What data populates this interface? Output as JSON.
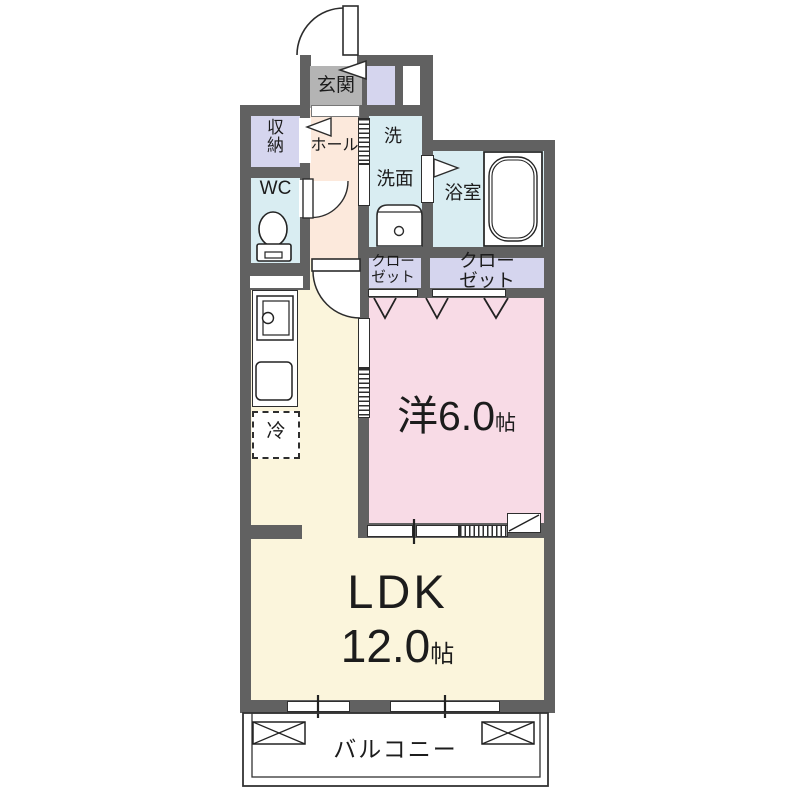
{
  "rooms": {
    "genkan": {
      "label": "玄関"
    },
    "storage": {
      "label": "収\n納"
    },
    "wc": {
      "label": "WC"
    },
    "hall": {
      "label": "ホール"
    },
    "laundry": {
      "label": "洗"
    },
    "washroom": {
      "label": "洗面"
    },
    "bathroom": {
      "label": "浴室"
    },
    "closet_left": {
      "label": "クロー\nゼット"
    },
    "closet_right": {
      "label": "クロー\nゼット"
    },
    "western_room": {
      "label": "洋6.0",
      "unit": "帖"
    },
    "refrigerator": {
      "label": "冷"
    },
    "ldk": {
      "label": "LDK",
      "size": "12.0",
      "unit": "帖"
    },
    "balcony": {
      "label": "バルコニー"
    }
  },
  "colors": {
    "wall": "#616161",
    "genkan_floor": "#b4b4b4",
    "hall_floor": "#fce9dc",
    "closet_fill": "#d5d5ee",
    "wet_area_fill": "#d9edf2",
    "bedroom_fill": "#f8dbe6",
    "ldk_fill": "#fbf5dc",
    "line": "#2c2c2c"
  }
}
